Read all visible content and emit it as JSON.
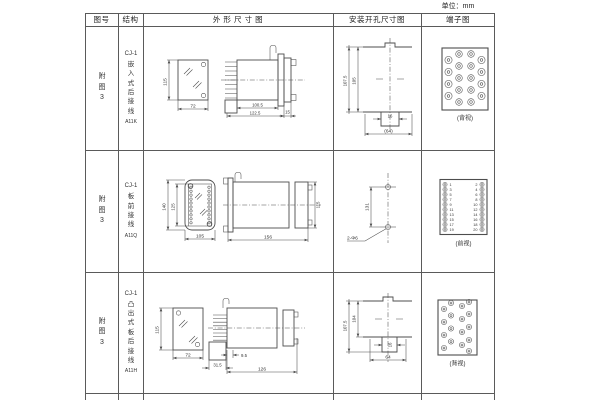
{
  "unit_label": "单位：mm",
  "headers": [
    "图号",
    "结构",
    "外 形 尺 寸 图",
    "安装开孔尺寸图",
    "端子图"
  ],
  "rows": [
    {
      "fig_no": "附图3",
      "structure": {
        "model": "CJ-1",
        "type": "嵌入式后接线",
        "code": "A11K"
      },
      "outline": {
        "front_height": "115",
        "front_width": "72",
        "body_length": "100.5",
        "overall_length": "122.5",
        "flange_depth": "15"
      },
      "install": {
        "outer_height": "107.5",
        "inner_height": "105",
        "slot_width": "16",
        "hole_span": "(64)"
      },
      "terminal": {
        "view_label": "(背视)"
      }
    },
    {
      "fig_no": "附图3",
      "structure": {
        "model": "CJ-1",
        "type": "板前接线",
        "code": "A11Q"
      },
      "outline": {
        "front_height": "140",
        "inner_height": "125",
        "front_width": "105",
        "body_length": "156",
        "side_height": "115"
      },
      "install": {
        "hole_spacing": "131",
        "holes_label": "2-Φ6"
      },
      "terminal": {
        "view_label": "(前视)",
        "left_numbers": [
          "1",
          "3",
          "5",
          "7",
          "9",
          "11",
          "13",
          "15",
          "17",
          "19"
        ],
        "right_numbers": [
          "2",
          "4",
          "6",
          "8",
          "10",
          "12",
          "14",
          "16",
          "18",
          "20"
        ]
      }
    },
    {
      "fig_no": "附图3",
      "structure": {
        "model": "CJ-1",
        "type": "凸出式板后接线",
        "code": "A11H"
      },
      "outline": {
        "front_height": "115",
        "front_width": "72",
        "pin_length": "31.5",
        "pin_offset": "9.5",
        "body_length": "126"
      },
      "install": {
        "outer_height": "107.5",
        "inner_height": "104",
        "slot_width": "16",
        "hole_span": "64"
      },
      "terminal": {
        "view_label": "(背视)"
      }
    }
  ]
}
